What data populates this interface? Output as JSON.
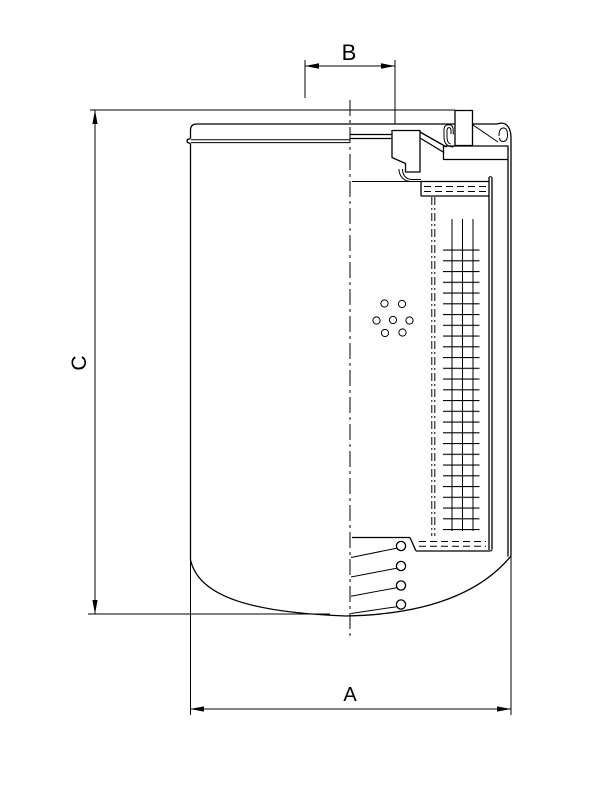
{
  "page": {
    "background_color": "#ffffff",
    "stroke_color": "#000000",
    "drawing_kind": "spin-on filter cartridge cross-section, dimensioned outline drawing"
  },
  "dimensions": {
    "top": {
      "label": "B"
    },
    "left": {
      "label": "C"
    },
    "bottom": {
      "label": "A"
    }
  }
}
